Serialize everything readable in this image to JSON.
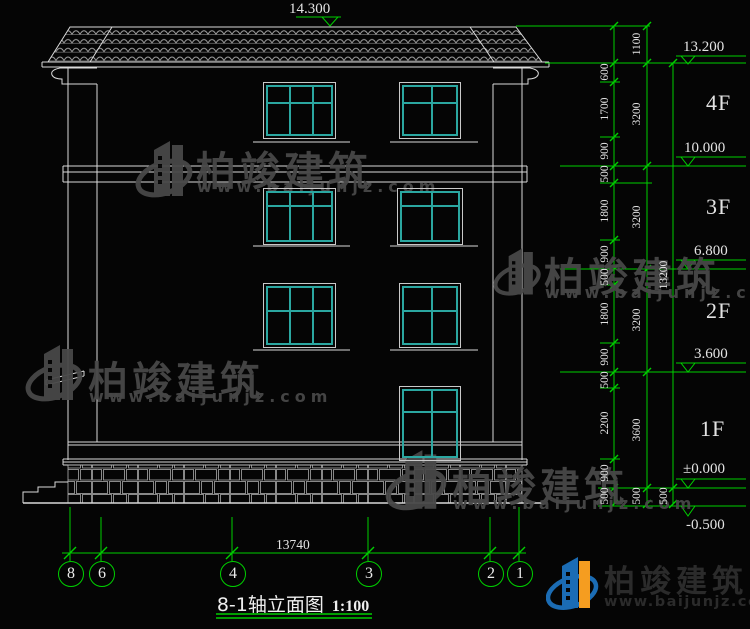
{
  "title": {
    "name": "8-1轴立面图",
    "scale": "1:100"
  },
  "levels": {
    "ridge": "14.300",
    "marks": [
      "13.200",
      "10.000",
      "6.800",
      "3.600",
      "±0.000",
      "-0.500"
    ]
  },
  "floors": [
    "4F",
    "3F",
    "2F",
    "1F"
  ],
  "axes": [
    "8",
    "6",
    "4",
    "3",
    "2",
    "1"
  ],
  "dims": {
    "col_inner": [
      "600",
      "1700",
      "900",
      "500",
      "1800",
      "900",
      "500",
      "1800",
      "900",
      "500",
      "2200",
      "900",
      "500"
    ],
    "col_floor": [
      "1100",
      "3200",
      "3200",
      "3200",
      "3600",
      "500"
    ],
    "col_total": [
      "13200",
      "500"
    ],
    "bottom_total": "13740"
  },
  "brand": {
    "name": "柏竣建筑",
    "url": "www.baijunjz.com"
  },
  "colors": {
    "line_green": "#00cf00",
    "line_white": "#d9d9d9",
    "window_teal": "#2ba7a1",
    "watermark_gray": "#484848",
    "text_white": "#e3e3e3",
    "logo_blue": "#1b6cb4",
    "logo_orange": "#f59d20",
    "logo_text": "#2b2b2b"
  }
}
